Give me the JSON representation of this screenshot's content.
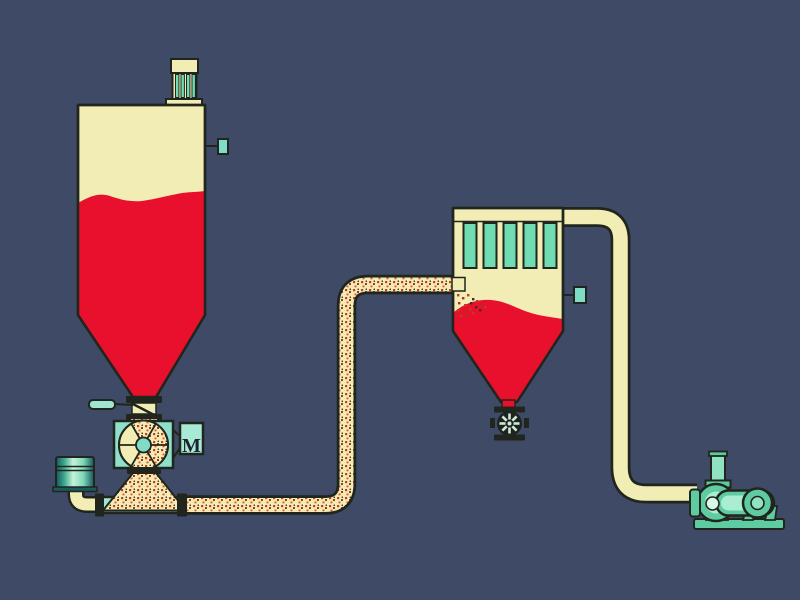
{
  "diagram": {
    "type": "pneumatic-conveying-system",
    "labels": {
      "motor": "M"
    },
    "components": [
      "storage-silo",
      "silo-vent-filter",
      "silo-level-sensor",
      "slide-gate-valve",
      "rotary-feeder-valve",
      "feeder-motor",
      "intake-silencer-drum",
      "blower-air-pipe",
      "conveying-pipe",
      "bag-filter-receiver",
      "receiver-filter-bags",
      "receiver-level-sensor",
      "receiver-discharge-valve",
      "exhaust-pipe",
      "vacuum-pump"
    ]
  },
  "colors": {
    "background": "#3E4A66",
    "outline": "#20251D",
    "vessel_cream": "#F2EDB4",
    "material_red": "#E8102C",
    "pipe_teal": "#9FE5D2",
    "filter_teal": "#6FDCB4",
    "valve_teal": "#8FE0CB",
    "sensor_teal": "#7FDCC6",
    "motor_box_teal": "#A9EAD6",
    "equipment_green": "#5FCBA0",
    "equipment_green_light": "#A9EDD3",
    "speckle_red": "#C93A22"
  }
}
